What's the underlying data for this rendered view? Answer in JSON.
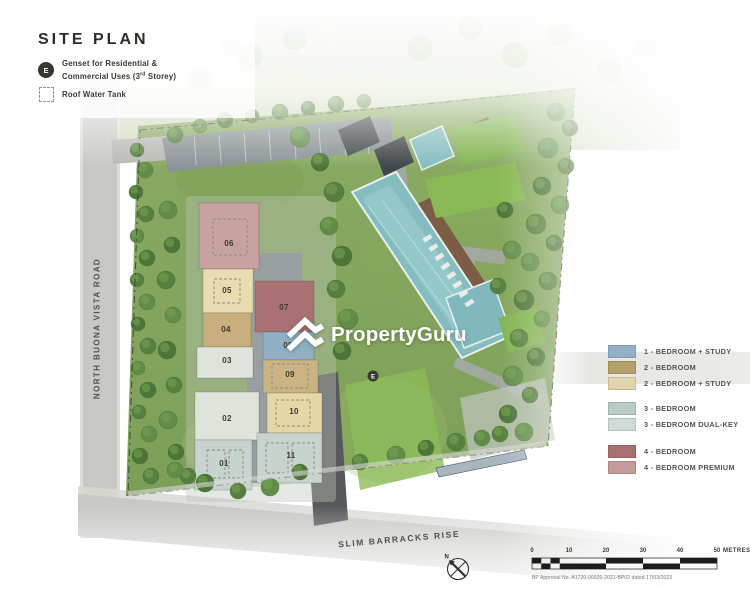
{
  "title": "SITE PLAN",
  "map_legend": {
    "genset_symbol": "E",
    "genset_line1": "Genset for Residential &",
    "genset_line2_pre": "Commercial Uses (3",
    "genset_line2_sup": "rd",
    "genset_line2_post": " Storey)",
    "roof_water_tank": "Roof Water Tank"
  },
  "roads": {
    "west": "NORTH BUONA VISTA ROAD",
    "south": "SLIM BARRACKS RISE"
  },
  "watermark": "PropertyGuru",
  "blocks": [
    {
      "number": "01"
    },
    {
      "number": "02"
    },
    {
      "number": "03"
    },
    {
      "number": "04"
    },
    {
      "number": "05"
    },
    {
      "number": "06"
    },
    {
      "number": "07"
    },
    {
      "number": "08"
    },
    {
      "number": "09"
    },
    {
      "number": "10"
    },
    {
      "number": "11"
    }
  ],
  "unit_legend": [
    {
      "label": "1 - BEDROOM + STUDY",
      "color": "#92b0c7"
    },
    {
      "label": "2 - BEDROOM",
      "color": "#b3a16a"
    },
    {
      "label": "2 - BEDROOM + STUDY",
      "color": "#e2d5a9"
    },
    {
      "label": "3 - BEDROOM",
      "color": "#b7ccc5"
    },
    {
      "label": "3 - BEDROOM DUAL-KEY",
      "color": "#cfdbd4"
    },
    {
      "label": "4 - BEDROOM",
      "color": "#a97072"
    },
    {
      "label": "4 - BEDROOM PREMIUM",
      "color": "#c59c99"
    }
  ],
  "scale_bar": {
    "ticks": [
      "0",
      "10",
      "20",
      "30",
      "40",
      "50"
    ],
    "unit": "METRES"
  },
  "compass_label": "N",
  "approval_note": "BP Approval No. A1720-00020-2021-BP02 dated 17/03/2023"
}
